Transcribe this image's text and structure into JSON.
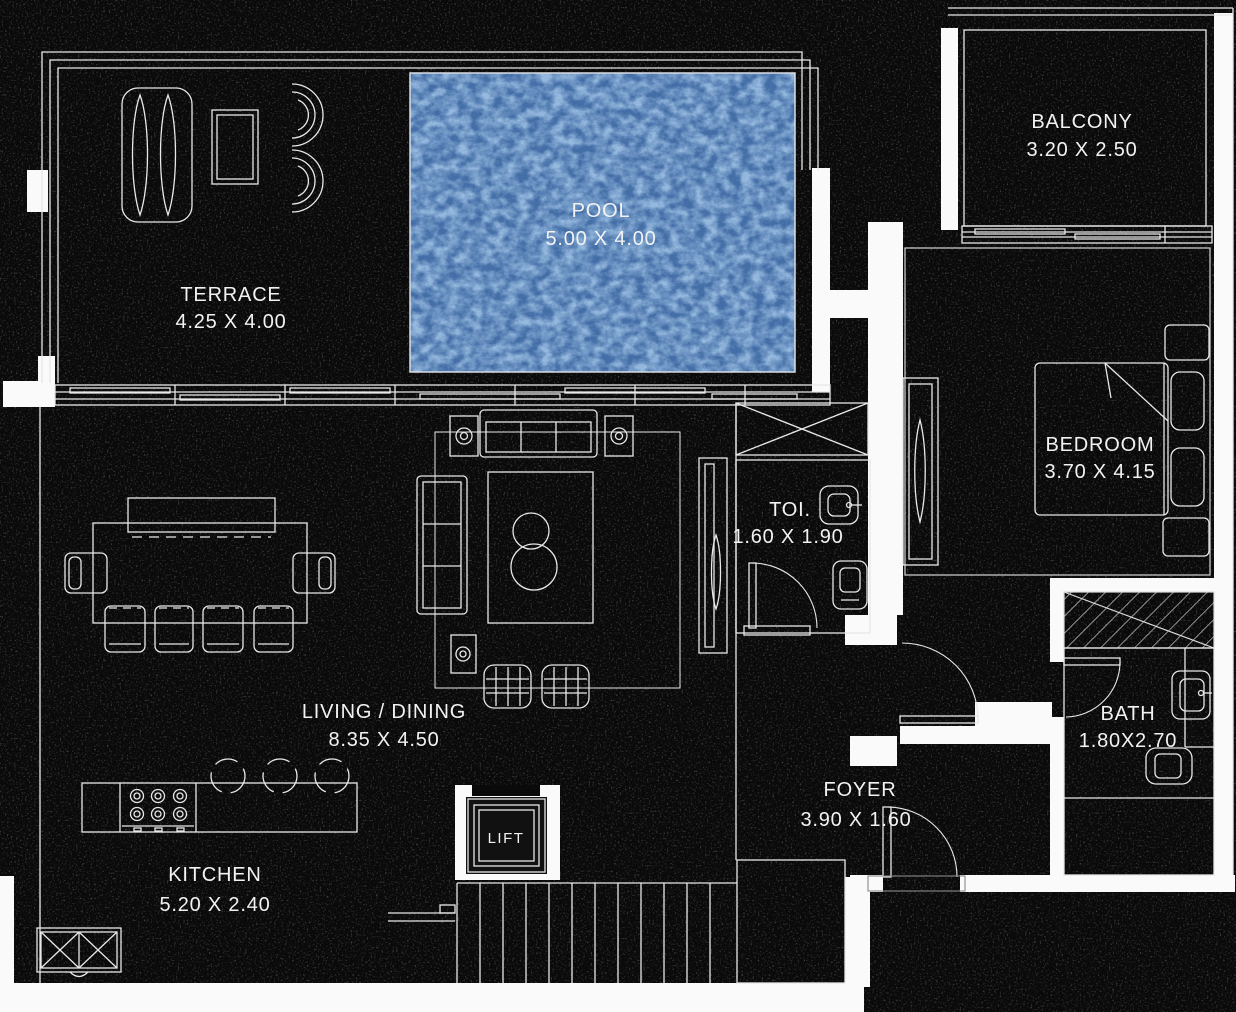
{
  "colors": {
    "background": "#0a0a0b",
    "wall": "#fafafa",
    "line": "#e8e8e8",
    "pool_fill": "#4d7cba",
    "label_text": "#f2f2f2"
  },
  "rooms": {
    "terrace": {
      "name": "TERRACE",
      "dims": "4.25 X 4.00"
    },
    "pool": {
      "name": "POOL",
      "dims": "5.00 X 4.00"
    },
    "balcony": {
      "name": "BALCONY",
      "dims": "3.20 X 2.50"
    },
    "bedroom": {
      "name": "BEDROOM",
      "dims": "3.70 X 4.15"
    },
    "toilet": {
      "name": "TOI.",
      "dims": "1.60 X 1.90"
    },
    "living_dining": {
      "name": "LIVING / DINING",
      "dims": "8.35 X 4.50"
    },
    "bath": {
      "name": "BATH",
      "dims": "1.80X2.70"
    },
    "foyer": {
      "name": "FOYER",
      "dims": "3.90 X 1.60"
    },
    "kitchen": {
      "name": "KITCHEN",
      "dims": "5.20 X 2.40"
    },
    "lift": {
      "name": "LIFT"
    }
  }
}
